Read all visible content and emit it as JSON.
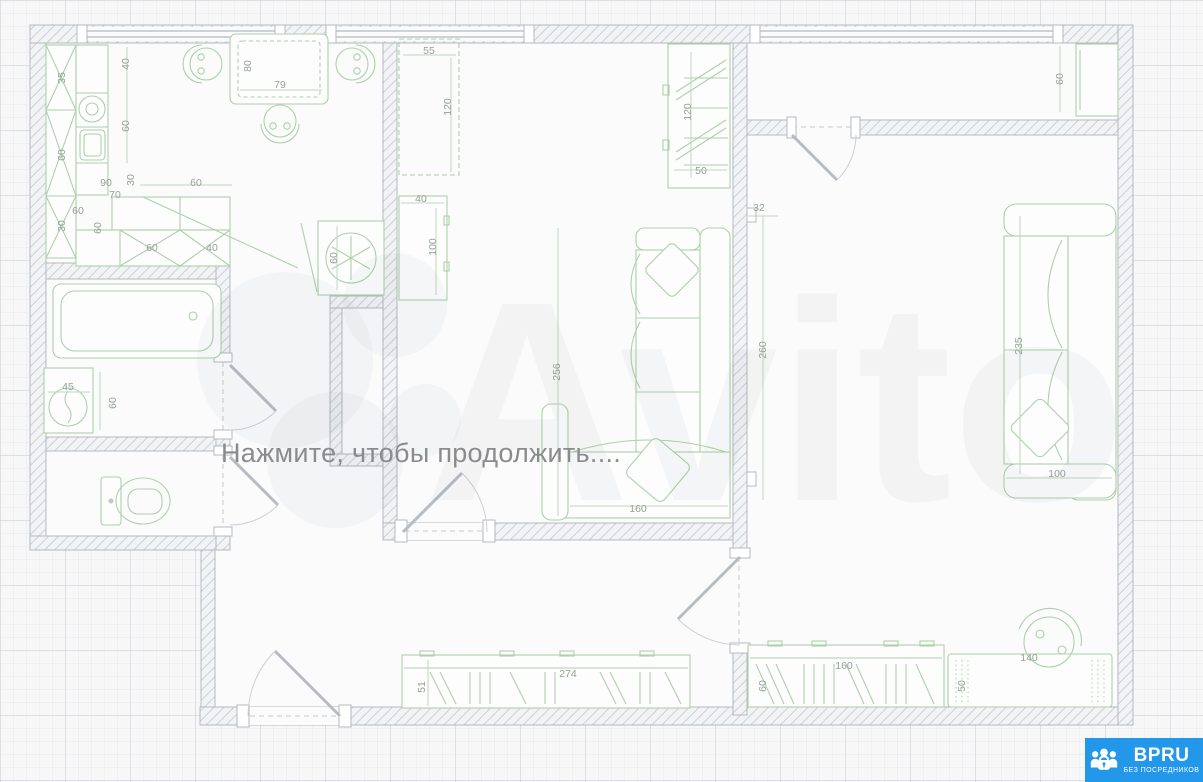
{
  "overlay": {
    "message": "Нажмите, чтобы продолжить...."
  },
  "watermark": {
    "brand": "Avito"
  },
  "badge": {
    "brand": "BPRU",
    "tagline": "БЕЗ ПОСРЕДНИКОВ",
    "color": "#2397ea",
    "icon": "people-lock-icon"
  },
  "plan": {
    "type": "apartment-floor-plan",
    "colors": {
      "wall": "#c9ccd2",
      "furniture": "#aed0aa",
      "dimension_text": "#95a295"
    },
    "dims": {
      "kitchen_cabinet_a": "35",
      "kitchen_cabinet_b": "60",
      "kitchen_cabinet_c": "30",
      "kitchen_counter_a": "40",
      "kitchen_counter_b": "60",
      "kitchen_opening_a": "90",
      "kitchen_opening_b": "70",
      "kitchen_opening_c": "30",
      "kitchen_opening_d": "60",
      "kitchen_lower_a": "60",
      "kitchen_lower_b": "60",
      "kitchen_lower_c": "60",
      "kitchen_lower_d": "40",
      "dining_table_depth": "80",
      "dining_table_width": "79",
      "fridge_width": "60",
      "desk_width": "55",
      "desk_length": "120",
      "living_cabinet_width": "40",
      "living_cabinet_length": "100",
      "living_wardrobe_length": "120",
      "living_wardrobe_depth": "50",
      "living_sofa_length": "256",
      "living_sofa_width": "160",
      "balcony_cabinet": "60",
      "bedroom_wall_a": "32",
      "bedroom_wall_b": "260",
      "bedroom_sofa_length": "235",
      "bedroom_sofa_width": "100",
      "bedroom_wardrobe_width": "160",
      "bedroom_wardrobe_depth": "60",
      "bedroom_dresser_depth": "50",
      "bedroom_dresser_width": "140",
      "washer_width": "45",
      "washer_depth": "60",
      "hall_wardrobe_width": "274",
      "hall_wardrobe_depth": "51"
    }
  }
}
